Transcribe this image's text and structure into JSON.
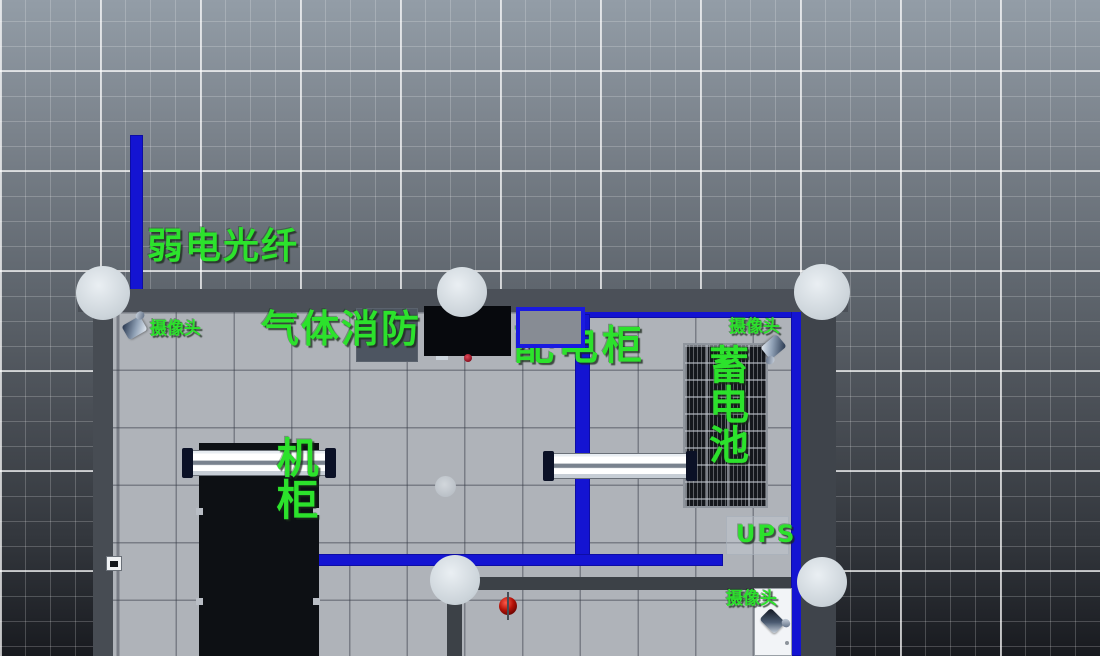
{
  "scene": {
    "annotations": {
      "fiber_tray_label": "弱电光纤",
      "gas_fire_label": "气体消防",
      "power_cabinet_label": "配电柜",
      "battery_label": "蓄电池",
      "server_rack_label": "机柜",
      "ups_label": "UPS",
      "camera_label_top_left": "摄像头",
      "camera_label_top_right": "摄像头",
      "camera_label_bottom_right": "摄像头"
    },
    "palette": {
      "label_green": "#2CE22C",
      "cable_tray_blue": "#1414D2",
      "floor_gray": "#AFB3B9",
      "wall_gray": "#4B5058",
      "column_gray": "#D6DCE1",
      "rack_black": "#0D1014",
      "battery_frame": "#8F959D",
      "power_box_border_blue": "#1A1AE0",
      "alarm_red": "#B41208"
    }
  }
}
